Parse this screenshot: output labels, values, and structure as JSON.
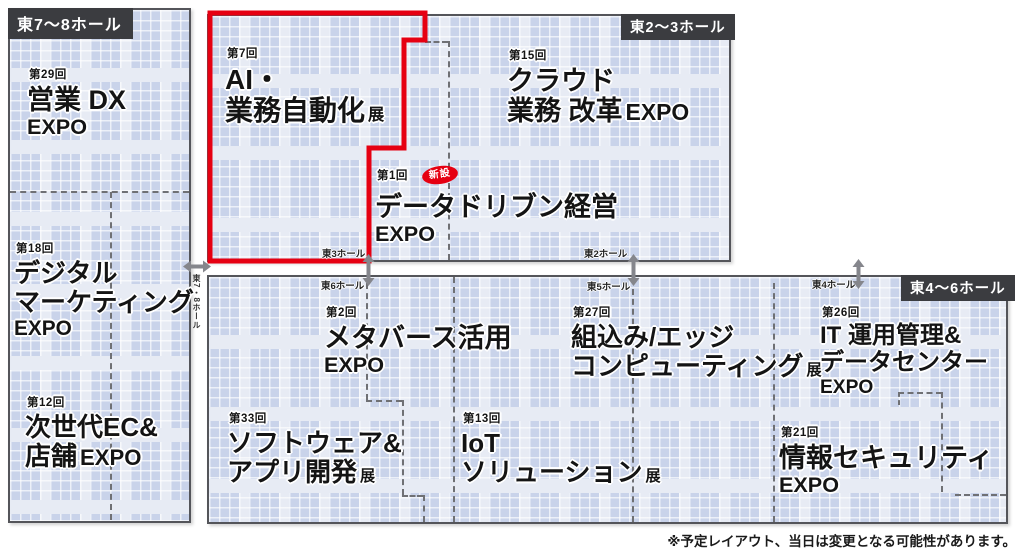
{
  "colors": {
    "booth": "#c9d3ea",
    "aisle": "#e7ebf4",
    "hall_border": "#54555a",
    "hall_tag_bg": "#3b3c40",
    "highlight_red": "#e60012",
    "arrow_gray": "#85868c"
  },
  "halls": {
    "east78": {
      "label": "東7〜8ホール"
    },
    "east23": {
      "label": "東2〜3ホール"
    },
    "east46": {
      "label": "東4〜6ホール"
    }
  },
  "corridor": {
    "east3": "東3ホール",
    "east2": "東2ホール",
    "east6": "東6ホール",
    "east5": "東5ホール",
    "east4": "東4ホール",
    "east78_vertical": "東7・8ホール"
  },
  "zones": {
    "sales_dx": {
      "edition": "第29回",
      "line1": "営業 DX",
      "line2": "EXPO"
    },
    "digital_marketing": {
      "edition": "第18回",
      "line1": "デジタル",
      "line2": "マーケティング",
      "line3": "EXPO"
    },
    "ec_store": {
      "edition": "第12回",
      "line1": "次世代EC&",
      "line2": "店舗",
      "suffix": "EXPO"
    },
    "ai_automation": {
      "edition": "第7回",
      "line1": "AI・",
      "line2": "業務自動化",
      "suffix": "展"
    },
    "cloud_bpr": {
      "edition": "第15回",
      "line1": "クラウド",
      "line2": "業務 改革",
      "suffix": "EXPO"
    },
    "data_driven": {
      "edition": "第1回",
      "badge": "新設",
      "line1": "データドリブン経営",
      "line2": "EXPO"
    },
    "metaverse": {
      "edition": "第2回",
      "line1": "メタバース活用",
      "line2": "EXPO"
    },
    "embedded_edge": {
      "edition": "第27回",
      "line1": "組込み/エッジ",
      "line2": "コンピューティング",
      "suffix": "展"
    },
    "it_ops_dc": {
      "edition": "第26回",
      "line1": "IT 運用管理&",
      "line2": "データセンター",
      "line3": "EXPO"
    },
    "software_app": {
      "edition": "第33回",
      "line1": "ソフトウェア&",
      "line2": "アプリ開発",
      "suffix": "展"
    },
    "iot_solution": {
      "edition": "第13回",
      "line1": "IoT",
      "line2": "ソリューション",
      "suffix": "展"
    },
    "info_security": {
      "edition": "第21回",
      "line1": "情報セキュリティ",
      "line2": "EXPO"
    }
  },
  "footnote": "※予定レイアウト、当日は変更となる可能性があります。"
}
